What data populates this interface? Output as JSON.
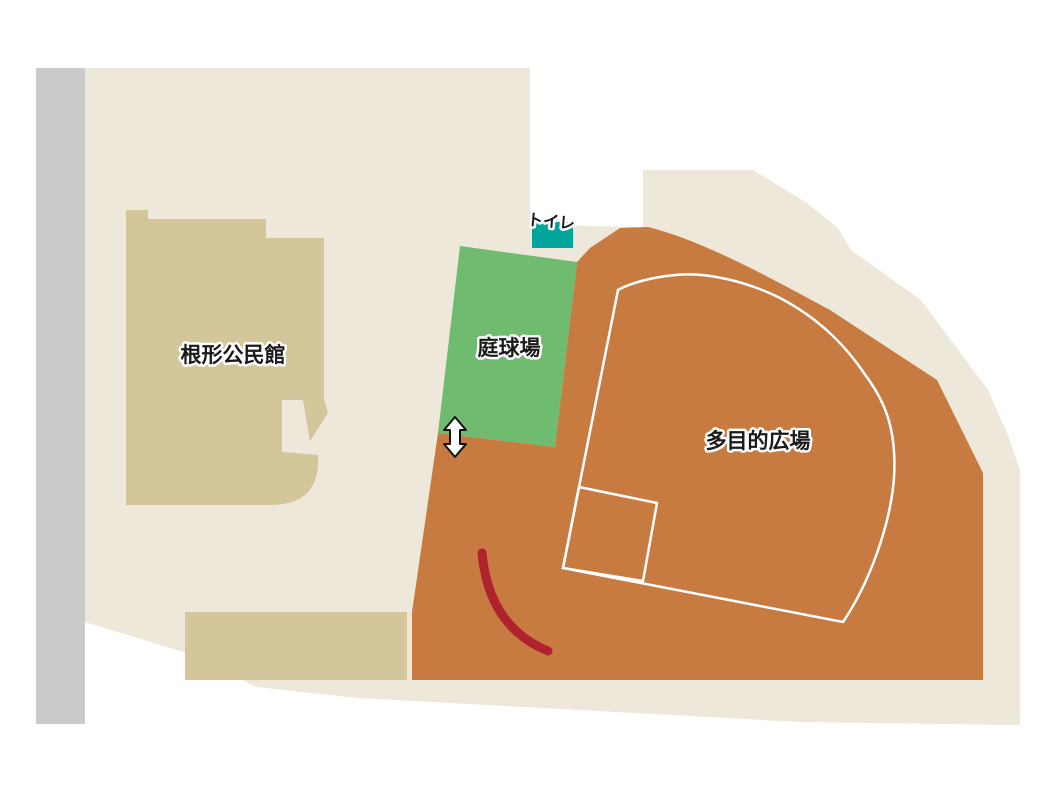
{
  "map": {
    "name": "根形公民館・運動広場 案内図",
    "regions": {
      "community_center": {
        "label": "根形公民館"
      },
      "tennis_court": {
        "label": "庭球場"
      },
      "multipurpose_plaza": {
        "label": "多目的広場"
      },
      "toilet": {
        "label": "トイレ"
      }
    },
    "colors": {
      "background": "#FFFFFF",
      "site_beige": "#EDE8D9",
      "building_tan": "#D3C69B",
      "field_orange": "#C87B40",
      "court_green": "#6FBC71",
      "toilet_teal": "#00A69B",
      "road_gray": "#CBCBCB",
      "curve_red": "#B0232E",
      "outline_white": "#FFFFFF",
      "label_text": "#1A1A1A",
      "arrow_fill": "#FFFFFF",
      "arrow_stroke": "#111111"
    }
  }
}
